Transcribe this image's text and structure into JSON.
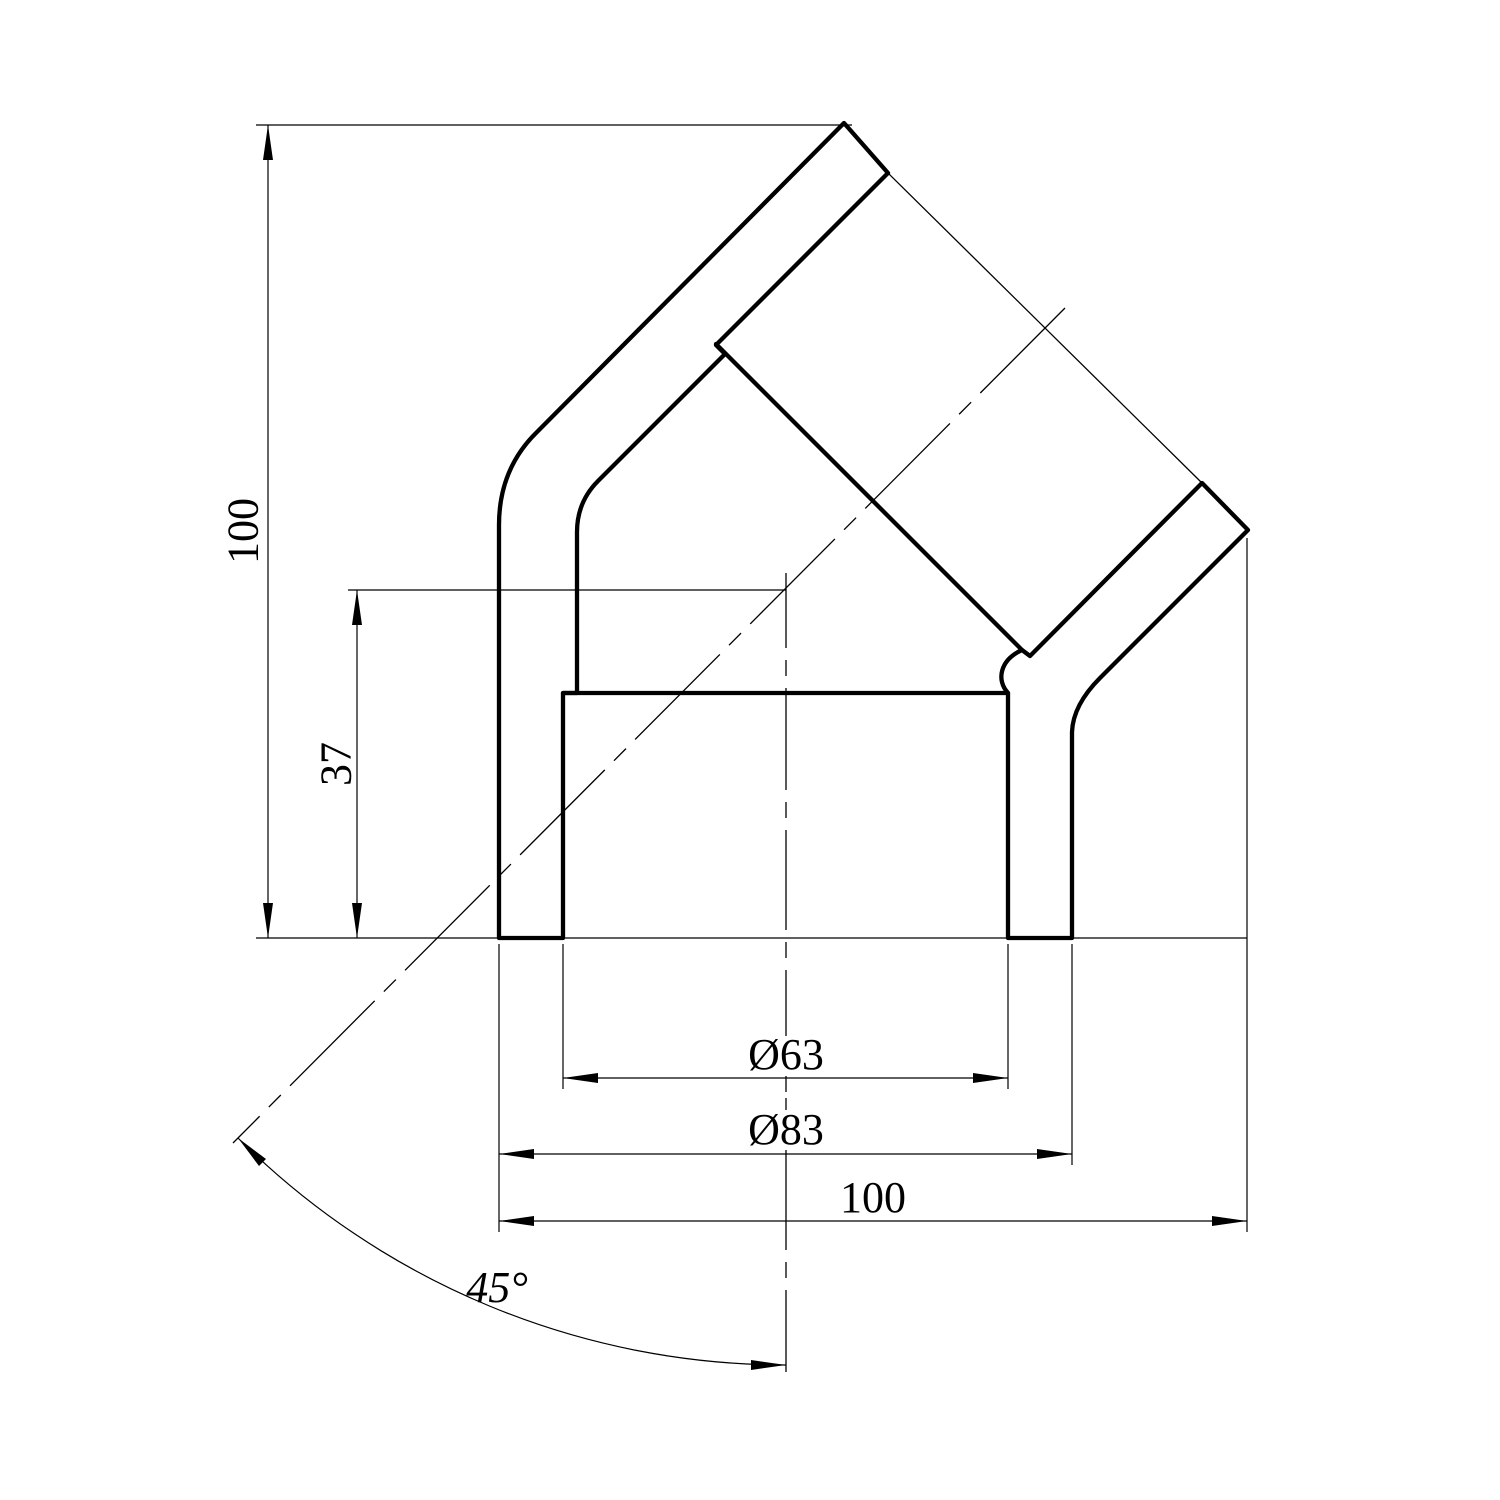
{
  "drawing": {
    "background_color": "#ffffff",
    "line_color": "#000000",
    "kind": "45-degree elbow fitting section view"
  },
  "dimensions": {
    "overall_height": {
      "label": "100"
    },
    "center_to_end": {
      "label": "37"
    },
    "socket_inner_diameter": {
      "label": "Ø63"
    },
    "body_outer_diameter": {
      "label": "Ø83"
    },
    "overall_width": {
      "label": "100"
    },
    "branch_angle": {
      "label": "45°"
    }
  }
}
